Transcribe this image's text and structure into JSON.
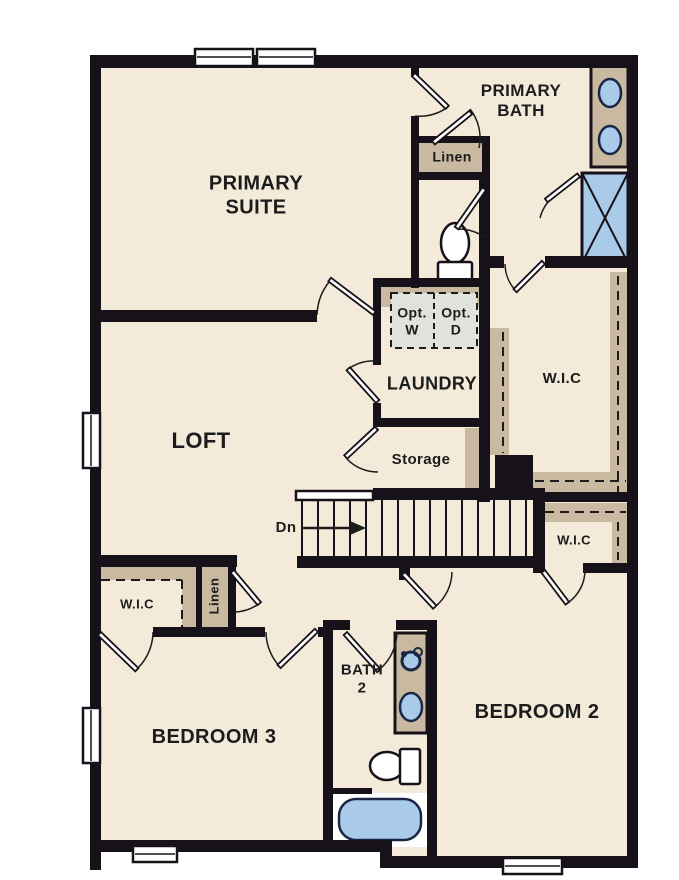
{
  "rooms": {
    "primary_suite": {
      "label": "PRIMARY SUITE"
    },
    "primary_bath": {
      "label": "PRIMARY BATH"
    },
    "loft": {
      "label": "LOFT"
    },
    "laundry": {
      "label": "LAUNDRY"
    },
    "storage": {
      "label": "Storage"
    },
    "bedroom_2": {
      "label": "BEDROOM 2"
    },
    "bedroom_3": {
      "label": "BEDROOM 3"
    },
    "bath_2": {
      "label": "BATH 2"
    }
  },
  "closets": {
    "wic_primary": {
      "label": "W.I.C"
    },
    "wic_hall": {
      "label": "W.I.C"
    },
    "wic_bedroom3": {
      "label": "W.I.C"
    },
    "linen_bath": {
      "label": "Linen"
    },
    "linen_hall": {
      "label": "Linen"
    }
  },
  "stairs": {
    "direction_label": "Dn"
  },
  "appliances": {
    "washer": {
      "line1": "Opt.",
      "line2": "W"
    },
    "dryer": {
      "line1": "Opt.",
      "line2": "D"
    }
  },
  "colors": {
    "background": "#ffffff",
    "floor": "#f3ead9",
    "wall": "#17121a",
    "tan": "#c9b9a0",
    "blue": "#a9cbe9",
    "blue_dark": "#1a2744",
    "gray": "#e2e2dc",
    "text": "#1c1c1c"
  }
}
